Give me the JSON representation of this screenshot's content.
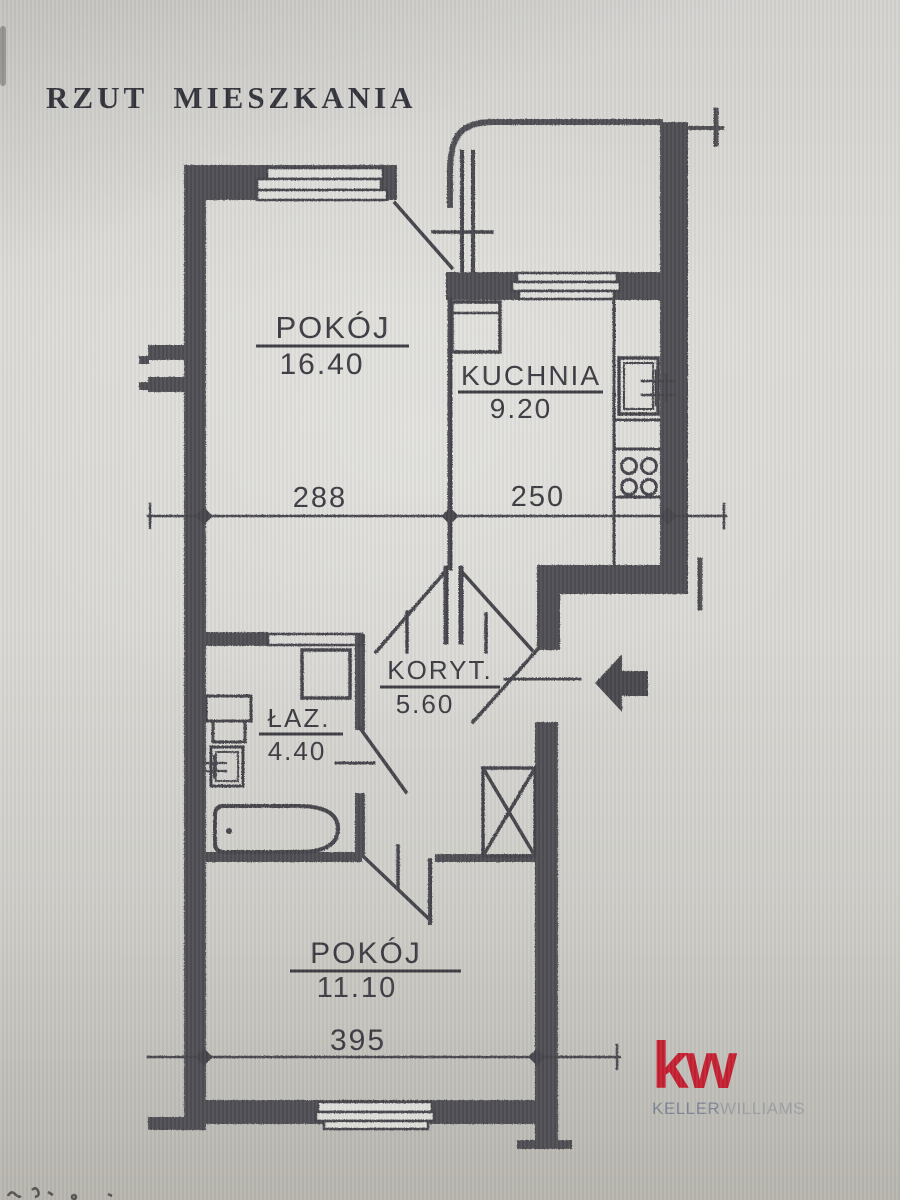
{
  "title": "RZUT MIESZKANIA",
  "plan": {
    "rooms": {
      "room_top": {
        "name": "POKÓJ",
        "area": "16.40"
      },
      "kitchen": {
        "name": "KUCHNIA",
        "area": "9.20"
      },
      "corridor": {
        "name": "KORYT.",
        "area": "5.60"
      },
      "bathroom": {
        "name": "ŁAZ.",
        "area": "4.40"
      },
      "room_bottom": {
        "name": "POKÓJ",
        "area": "11.10"
      }
    },
    "dimensions": {
      "room_top_width": "288",
      "kitchen_width": "250",
      "room_bottom_width": "395"
    }
  },
  "branding": {
    "logo_mark": "kw",
    "logo_name_primary": "KELLER",
    "logo_name_secondary": "WILLIAMS"
  },
  "colors": {
    "ink": "#45454b",
    "wall_fill": "#4e4e52",
    "logo_red": "#c42031",
    "logo_text_gray": "#7d8694",
    "paper": "#d8d7d3"
  }
}
